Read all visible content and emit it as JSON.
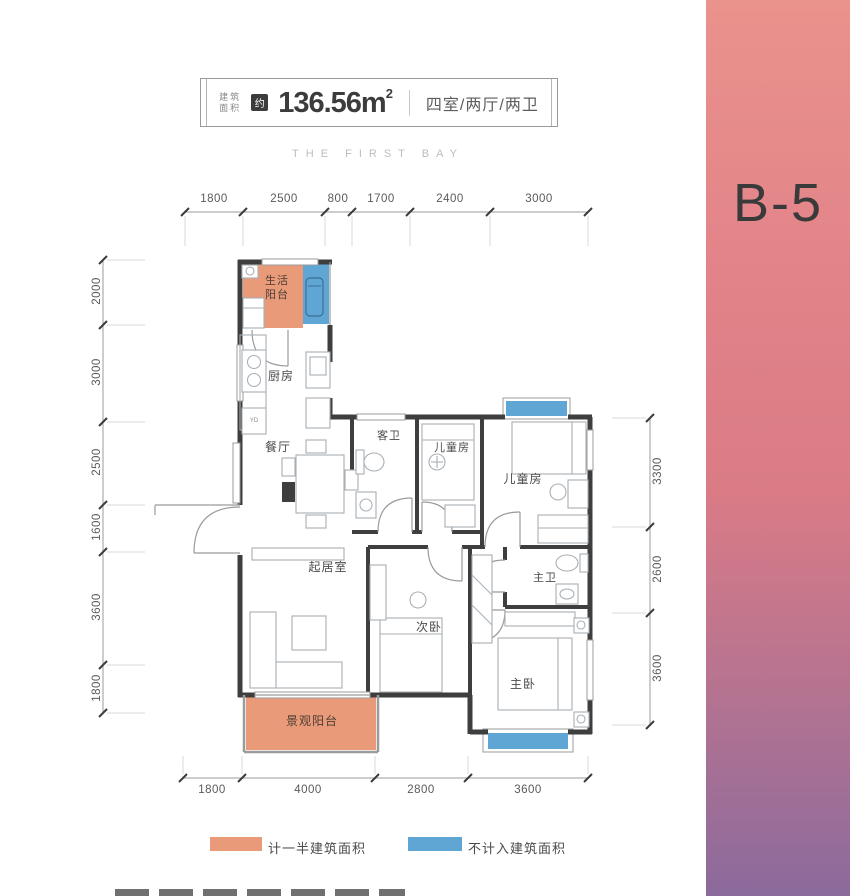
{
  "header": {
    "area_label_line1": "建筑",
    "area_label_line2": "面积",
    "approx_badge": "约",
    "area_value": "136.56m",
    "area_sup": "2",
    "layout": "四室/两厅/两卫"
  },
  "subtitle": "THE FIRST BAY",
  "unit_label": "B-5",
  "rooms": {
    "life_balcony": {
      "label": "生活\n阳台"
    },
    "kitchen": {
      "label": "厨房"
    },
    "dining": {
      "label": "餐厅"
    },
    "guest_bath": {
      "label": "客卫"
    },
    "kids_room_1": {
      "label": "儿童房"
    },
    "kids_room_2": {
      "label": "儿童房"
    },
    "living": {
      "label": "起居室"
    },
    "second_bedroom": {
      "label": "次卧"
    },
    "master_bath": {
      "label": "主卫"
    },
    "master_bedroom": {
      "label": "主卧"
    },
    "view_balcony": {
      "label": "景观阳台"
    },
    "flue_marker": {
      "label": "YD"
    }
  },
  "dimensions": {
    "top": [
      "1800",
      "2500",
      "800",
      "1700",
      "2400",
      "3000"
    ],
    "left": [
      "2000",
      "3000",
      "2500",
      "1600",
      "3600",
      "1800"
    ],
    "right": [
      "3300",
      "2600",
      "3600"
    ],
    "bottom": [
      "1800",
      "4000",
      "2800",
      "3600"
    ]
  },
  "legend": {
    "items": [
      {
        "label": "计一半建筑面积",
        "color": "#E99B79"
      },
      {
        "label": "不计入建筑面积",
        "color": "#5FA6D5"
      }
    ]
  },
  "colors": {
    "accent_orange": "#E99B79",
    "accent_blue": "#5FA6D5",
    "panel_top": "#EA928C",
    "panel_mid": "#DA7B86",
    "panel_bottom": "#8B6A9C",
    "wall": "#3E3E3E"
  }
}
